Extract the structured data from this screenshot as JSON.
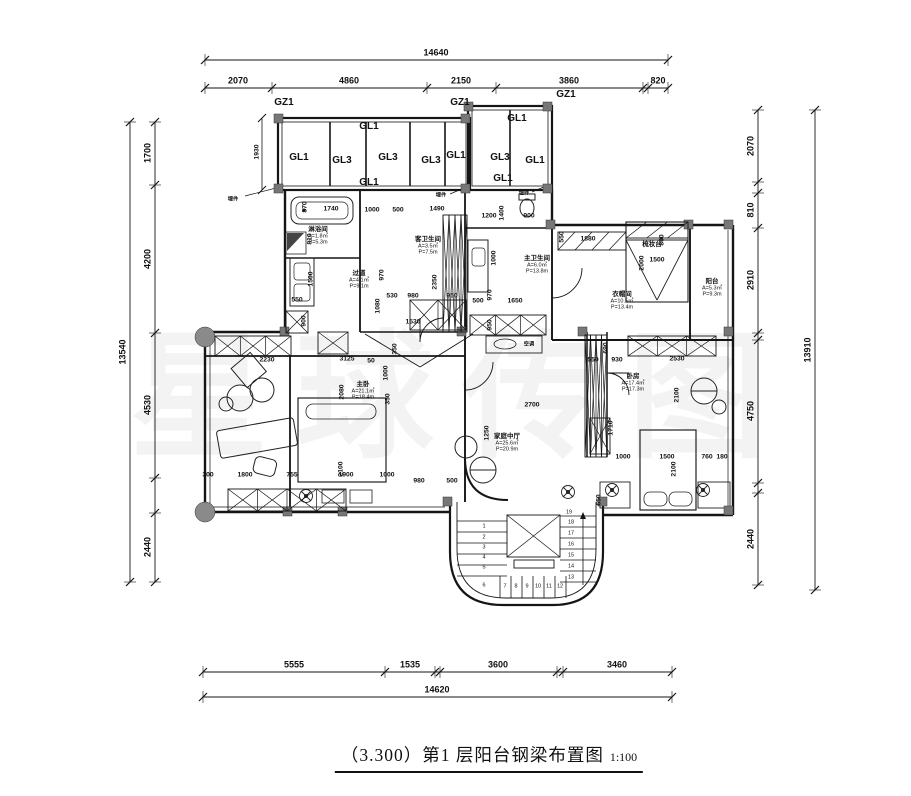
{
  "title": {
    "text": "（3.300）第1 层阳台钢梁布置图",
    "scale": "1:100"
  },
  "watermark": "星球传图",
  "colors": {
    "line": "#151515",
    "column_fill": "#777777",
    "hatch": "#333333"
  },
  "strips": {
    "h": [
      {
        "y": 60,
        "x0": 205,
        "x1": 668,
        "ticks": [
          205,
          668
        ],
        "labels": [
          {
            "t": "14640",
            "c": 436
          }
        ]
      },
      {
        "y": 88,
        "x0": 205,
        "x1": 668,
        "ticks": [
          205,
          272,
          427,
          496,
          643,
          648,
          668
        ],
        "labels": [
          {
            "t": "2070",
            "c": 238
          },
          {
            "t": "4860",
            "c": 349
          },
          {
            "t": "2150",
            "c": 461
          },
          {
            "t": "3860",
            "c": 569
          },
          {
            "t": "820",
            "c": 658
          }
        ]
      },
      {
        "y": 672,
        "x0": 203,
        "x1": 672,
        "ticks": [
          203,
          385,
          435,
          440,
          557,
          563,
          672
        ],
        "labels": [
          {
            "t": "5555",
            "c": 294
          },
          {
            "t": "1535",
            "c": 410
          },
          {
            "t": "3600",
            "c": 498
          },
          {
            "t": "3460",
            "c": 617
          }
        ]
      },
      {
        "y": 697,
        "x0": 203,
        "x1": 672,
        "ticks": [
          203,
          672
        ],
        "labels": [
          {
            "t": "14620",
            "c": 437
          }
        ]
      }
    ],
    "v": [
      {
        "x": 130,
        "y0": 122,
        "y1": 582,
        "ticks": [
          122,
          582
        ],
        "labels": [
          {
            "t": "13540",
            "c": 352
          }
        ]
      },
      {
        "x": 155,
        "y0": 122,
        "y1": 582,
        "ticks": [
          122,
          185,
          333,
          478,
          513,
          582
        ],
        "labels": [
          {
            "t": "1700",
            "c": 153
          },
          {
            "t": "4200",
            "c": 259
          },
          {
            "t": "4530",
            "c": 405
          },
          {
            "t": "2440",
            "c": 547
          }
        ]
      },
      {
        "x": 758,
        "y0": 110,
        "y1": 585,
        "ticks": [
          110,
          182,
          193,
          228,
          333,
          340,
          483,
          493,
          585
        ],
        "labels": [
          {
            "t": "2070",
            "c": 146
          },
          {
            "t": "810",
            "c": 210
          },
          {
            "t": "2910",
            "c": 280
          },
          {
            "t": "4750",
            "c": 411
          },
          {
            "t": "2440",
            "c": 539
          }
        ]
      },
      {
        "x": 815,
        "y0": 110,
        "y1": 590,
        "ticks": [
          110,
          590
        ],
        "labels": [
          {
            "t": "13910",
            "c": 350
          }
        ]
      }
    ]
  },
  "plan": {
    "texts": [
      {
        "t": "GZ1",
        "x": 284,
        "y": 103,
        "s": 4,
        "n": "column-label"
      },
      {
        "t": "GZ1",
        "x": 460,
        "y": 103,
        "s": 4,
        "n": "column-label"
      },
      {
        "t": "GZ1",
        "x": 566,
        "y": 95,
        "s": 4,
        "n": "column-label"
      },
      {
        "t": "GL1",
        "x": 299,
        "y": 158,
        "s": 4,
        "n": "beam-label"
      },
      {
        "t": "GL3",
        "x": 342,
        "y": 161,
        "s": 4,
        "n": "beam-label"
      },
      {
        "t": "GL3",
        "x": 388,
        "y": 158,
        "s": 4,
        "n": "beam-label"
      },
      {
        "t": "GL3",
        "x": 431,
        "y": 161,
        "s": 4,
        "n": "beam-label"
      },
      {
        "t": "GL1",
        "x": 456,
        "y": 156,
        "s": 4,
        "n": "beam-label"
      },
      {
        "t": "GL1",
        "x": 369,
        "y": 127,
        "s": 4,
        "n": "beam-label"
      },
      {
        "t": "GL1",
        "x": 369,
        "y": 183,
        "s": 4,
        "n": "beam-label"
      },
      {
        "t": "GL1",
        "x": 517,
        "y": 119,
        "s": 4,
        "n": "beam-label"
      },
      {
        "t": "GL3",
        "x": 500,
        "y": 158,
        "s": 4,
        "n": "beam-label"
      },
      {
        "t": "GL1",
        "x": 535,
        "y": 161,
        "s": 4,
        "n": "beam-label"
      },
      {
        "t": "GL1",
        "x": 503,
        "y": 179,
        "s": 4,
        "n": "beam-label"
      },
      {
        "t": "1930",
        "x": 258,
        "y": 152,
        "r": -90,
        "s": 2
      },
      {
        "t": "埋件",
        "x": 233,
        "y": 200,
        "s": 6,
        "n": "embed-part-label"
      },
      {
        "t": "埋件",
        "x": 441,
        "y": 196,
        "s": 6,
        "n": "embed-part-label"
      },
      {
        "t": "埋件",
        "x": 524,
        "y": 194,
        "s": 6,
        "n": "embed-part-label"
      },
      {
        "t": "870",
        "x": 306,
        "y": 207,
        "r": -90
      },
      {
        "t": "1740",
        "x": 331,
        "y": 210
      },
      {
        "t": "1000",
        "x": 372,
        "y": 211
      },
      {
        "t": "500",
        "x": 398,
        "y": 211
      },
      {
        "t": "1490",
        "x": 437,
        "y": 210
      },
      {
        "t": "810",
        "x": 311,
        "y": 239,
        "r": -90
      },
      {
        "t": "1500",
        "x": 312,
        "y": 279,
        "r": -90
      },
      {
        "t": "550",
        "x": 297,
        "y": 301
      },
      {
        "t": "900",
        "x": 305,
        "y": 321,
        "r": -90
      },
      {
        "t": "970",
        "x": 383,
        "y": 275,
        "r": -90
      },
      {
        "t": "1080",
        "x": 379,
        "y": 306,
        "r": -90
      },
      {
        "t": "530",
        "x": 392,
        "y": 297
      },
      {
        "t": "980",
        "x": 413,
        "y": 297
      },
      {
        "t": "950",
        "x": 452,
        "y": 297
      },
      {
        "t": "2350",
        "x": 436,
        "y": 282,
        "r": -90
      },
      {
        "t": "1530",
        "x": 413,
        "y": 323
      },
      {
        "t": "1200",
        "x": 489,
        "y": 217
      },
      {
        "t": "1400",
        "x": 503,
        "y": 213,
        "r": -90
      },
      {
        "t": "900",
        "x": 529,
        "y": 217
      },
      {
        "t": "550",
        "x": 563,
        "y": 237,
        "r": -90
      },
      {
        "t": "1880",
        "x": 588,
        "y": 240
      },
      {
        "t": "800",
        "x": 663,
        "y": 240,
        "r": -90
      },
      {
        "t": "2000",
        "x": 643,
        "y": 263,
        "r": -90
      },
      {
        "t": "1500",
        "x": 657,
        "y": 261
      },
      {
        "t": "1000",
        "x": 495,
        "y": 258,
        "r": -90
      },
      {
        "t": "970",
        "x": 491,
        "y": 295,
        "r": -90
      },
      {
        "t": "500",
        "x": 478,
        "y": 302
      },
      {
        "t": "1650",
        "x": 515,
        "y": 302
      },
      {
        "t": "950",
        "x": 491,
        "y": 325,
        "r": -90
      },
      {
        "t": "2230",
        "x": 267,
        "y": 361
      },
      {
        "t": "3125",
        "x": 347,
        "y": 360
      },
      {
        "t": "50",
        "x": 371,
        "y": 362
      },
      {
        "t": "350",
        "x": 396,
        "y": 349,
        "r": -90
      },
      {
        "t": "1000",
        "x": 387,
        "y": 373,
        "r": -90
      },
      {
        "t": "350",
        "x": 389,
        "y": 399,
        "r": -90
      },
      {
        "t": "2080",
        "x": 343,
        "y": 392,
        "r": -90
      },
      {
        "t": "2100",
        "x": 342,
        "y": 469,
        "r": -90
      },
      {
        "t": "300",
        "x": 208,
        "y": 476
      },
      {
        "t": "1800",
        "x": 245,
        "y": 476
      },
      {
        "t": "755",
        "x": 292,
        "y": 476
      },
      {
        "t": "1900",
        "x": 346,
        "y": 476
      },
      {
        "t": "1000",
        "x": 387,
        "y": 476
      },
      {
        "t": "650",
        "x": 600,
        "y": 500,
        "r": -90
      },
      {
        "t": "690",
        "x": 607,
        "y": 348,
        "r": -90
      },
      {
        "t": "550",
        "x": 593,
        "y": 361
      },
      {
        "t": "930",
        "x": 617,
        "y": 361
      },
      {
        "t": "2530",
        "x": 677,
        "y": 360
      },
      {
        "t": "2100",
        "x": 678,
        "y": 395,
        "r": -90
      },
      {
        "t": "1710",
        "x": 612,
        "y": 428,
        "r": -90
      },
      {
        "t": "1000",
        "x": 623,
        "y": 458
      },
      {
        "t": "1500",
        "x": 667,
        "y": 458
      },
      {
        "t": "760",
        "x": 707,
        "y": 458
      },
      {
        "t": "180",
        "x": 722,
        "y": 458
      },
      {
        "t": "2700",
        "x": 532,
        "y": 406
      },
      {
        "t": "1250",
        "x": 488,
        "y": 433,
        "r": -90
      },
      {
        "t": "500",
        "x": 452,
        "y": 482
      },
      {
        "t": "2100",
        "x": 675,
        "y": 469,
        "r": -90
      },
      {
        "t": "980",
        "x": 419,
        "y": 482
      },
      {
        "t": "空调",
        "x": 529,
        "y": 345,
        "s": 6,
        "n": "ac-label"
      }
    ],
    "rooms": [
      {
        "name": "过道",
        "area": "A=4.1㎡",
        "perim": "P=9.1m",
        "x": 359,
        "y": 274
      },
      {
        "name": "淋浴间",
        "area": "A=1.8㎡",
        "perim": "P=5.3m",
        "x": 318,
        "y": 230
      },
      {
        "name": "客卫生间",
        "area": "A=3.5㎡",
        "perim": "P=7.5m",
        "x": 428,
        "y": 240
      },
      {
        "name": "主卫生间",
        "area": "A=6.0㎡",
        "perim": "P=13.8m",
        "x": 537,
        "y": 259
      },
      {
        "name": "衣帽间",
        "area": "A=10.5㎡",
        "perim": "P=13.4m",
        "x": 622,
        "y": 295
      },
      {
        "name": "阳台",
        "area": "A=5.3㎡",
        "perim": "P=9.3m",
        "x": 712,
        "y": 282
      },
      {
        "name": "主卧",
        "area": "A=21.1㎡",
        "perim": "P=18.4m",
        "x": 363,
        "y": 385
      },
      {
        "name": "家庭中厅",
        "area": "A=25.6㎡",
        "perim": "P=20.9m",
        "x": 507,
        "y": 437
      },
      {
        "name": "卧房",
        "area": "A=17.4㎡",
        "perim": "P=17.3m",
        "x": 633,
        "y": 377
      },
      {
        "name": "梳妆台",
        "area": "",
        "perim": "",
        "x": 652,
        "y": 245
      }
    ],
    "stair_numbers": [
      {
        "t": "1",
        "x": 484,
        "y": 527
      },
      {
        "t": "2",
        "x": 484,
        "y": 538
      },
      {
        "t": "3",
        "x": 484,
        "y": 548
      },
      {
        "t": "4",
        "x": 484,
        "y": 558
      },
      {
        "t": "5",
        "x": 484,
        "y": 568
      },
      {
        "t": "6",
        "x": 484,
        "y": 586
      },
      {
        "t": "7",
        "x": 505,
        "y": 587
      },
      {
        "t": "8",
        "x": 516,
        "y": 587
      },
      {
        "t": "9",
        "x": 527,
        "y": 587
      },
      {
        "t": "10",
        "x": 538,
        "y": 587
      },
      {
        "t": "11",
        "x": 549,
        "y": 587
      },
      {
        "t": "12",
        "x": 560,
        "y": 587
      },
      {
        "t": "13",
        "x": 571,
        "y": 578
      },
      {
        "t": "14",
        "x": 571,
        "y": 567
      },
      {
        "t": "15",
        "x": 571,
        "y": 556
      },
      {
        "t": "16",
        "x": 571,
        "y": 545
      },
      {
        "t": "17",
        "x": 571,
        "y": 534
      },
      {
        "t": "18",
        "x": 571,
        "y": 523
      },
      {
        "t": "19",
        "x": 569,
        "y": 513
      }
    ],
    "x_strips": [
      [
        215,
        336,
        76,
        20,
        3
      ],
      [
        228,
        489,
        118,
        22,
        4
      ],
      [
        443,
        215,
        24,
        117,
        4
      ],
      [
        410,
        300,
        56,
        30,
        2
      ],
      [
        318,
        332,
        30,
        22,
        1
      ],
      [
        286,
        311,
        22,
        22,
        1
      ],
      [
        585,
        335,
        22,
        122,
        4
      ],
      [
        628,
        336,
        88,
        20,
        3
      ],
      [
        590,
        418,
        20,
        36,
        1
      ],
      [
        470,
        315,
        76,
        20,
        3
      ],
      [
        507,
        515,
        53,
        42,
        1
      ]
    ],
    "diag_strips": [
      [
        558,
        232,
        68,
        18,
        4
      ],
      [
        626,
        222,
        62,
        16,
        3
      ]
    ]
  }
}
